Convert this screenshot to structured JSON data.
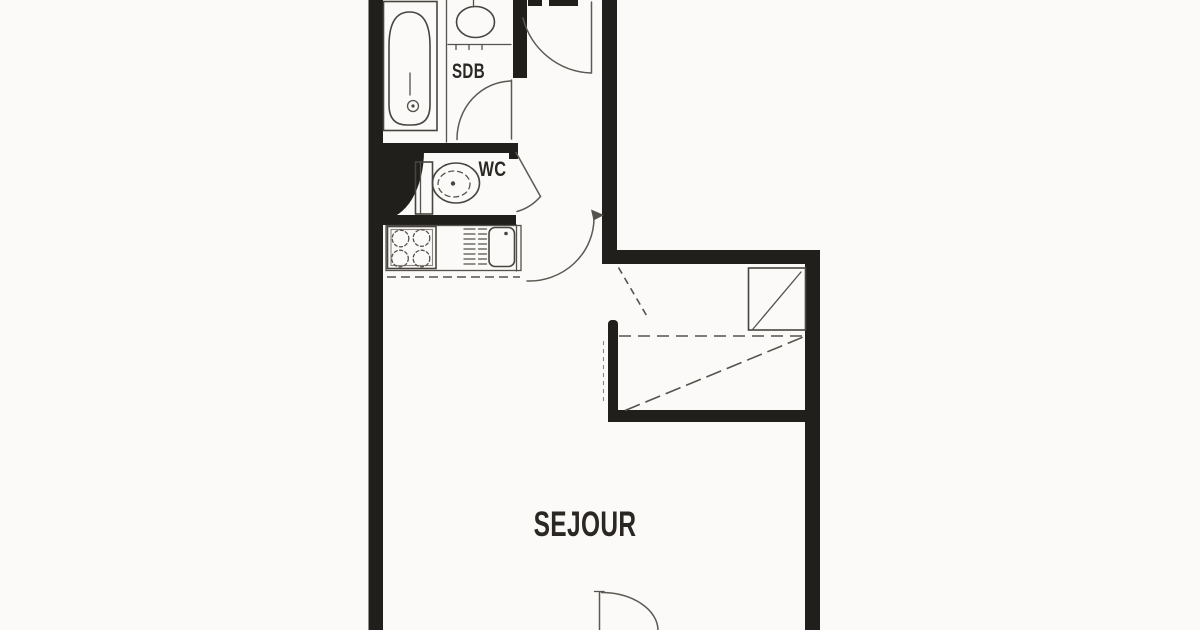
{
  "page": {
    "type": "apartment-floor-plan",
    "style": "scanned black-and-white architectural plan, cropped top and bottom"
  },
  "labels": {
    "bathroom": "SDB",
    "toilet": "WC",
    "living_room": "SEJOUR"
  },
  "rooms": [
    {
      "name": "SDB",
      "meaning": "salle de bain (bathroom)",
      "position": "top-left"
    },
    {
      "name": "WC",
      "meaning": "toilet room",
      "position": "left, below bathroom"
    },
    {
      "name": "kitchenette",
      "meaning": "hob + sink counter",
      "position": "left, below WC"
    },
    {
      "name": "entry-hall",
      "position": "top-center"
    },
    {
      "name": "bed-alcove",
      "meaning": "fold-down bed recess",
      "position": "middle-right"
    },
    {
      "name": "SEJOUR",
      "meaning": "living room",
      "position": "bottom-center"
    }
  ],
  "fixtures": [
    "bathtub",
    "washbasin",
    "bathroom-door-swing",
    "entry-door-swing",
    "toilet",
    "wc-door-swing",
    "stove-hob",
    "kitchen-sink-drainboard",
    "passage-door-swing-arrow",
    "fold-down-bed-diagram",
    "balcony-door-swing"
  ],
  "colors": {
    "background": "#fbfaf8",
    "wall": "#211f1c",
    "line": "#48443f",
    "label": "#2b2824"
  }
}
